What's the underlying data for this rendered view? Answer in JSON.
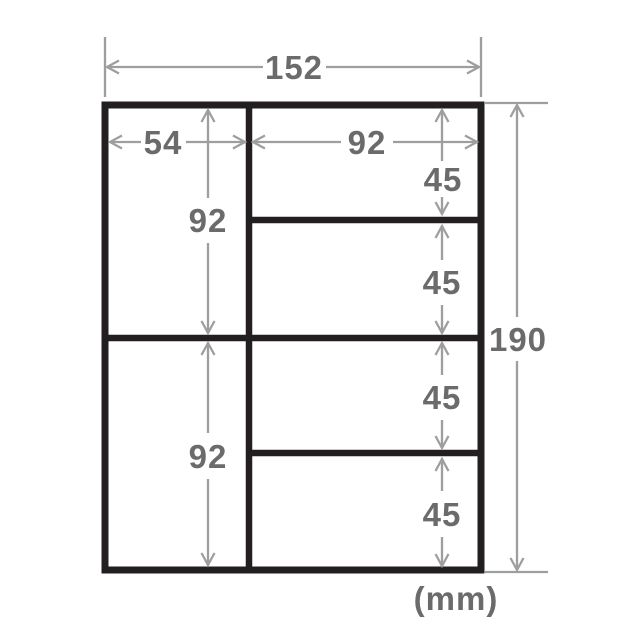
{
  "diagram": {
    "unit_label": "(mm)",
    "overall": {
      "width_label": "152",
      "height_label": "190"
    },
    "left_column": {
      "width_label": "54",
      "row_height_labels": [
        "92",
        "92"
      ]
    },
    "right_column": {
      "width_label": "92",
      "row_height_labels": [
        "45",
        "45",
        "45",
        "45"
      ]
    },
    "colors": {
      "outline": "#231f20",
      "dimension_line": "#9e9e9e",
      "label_text": "#6b6b6b",
      "background": "#ffffff"
    }
  }
}
